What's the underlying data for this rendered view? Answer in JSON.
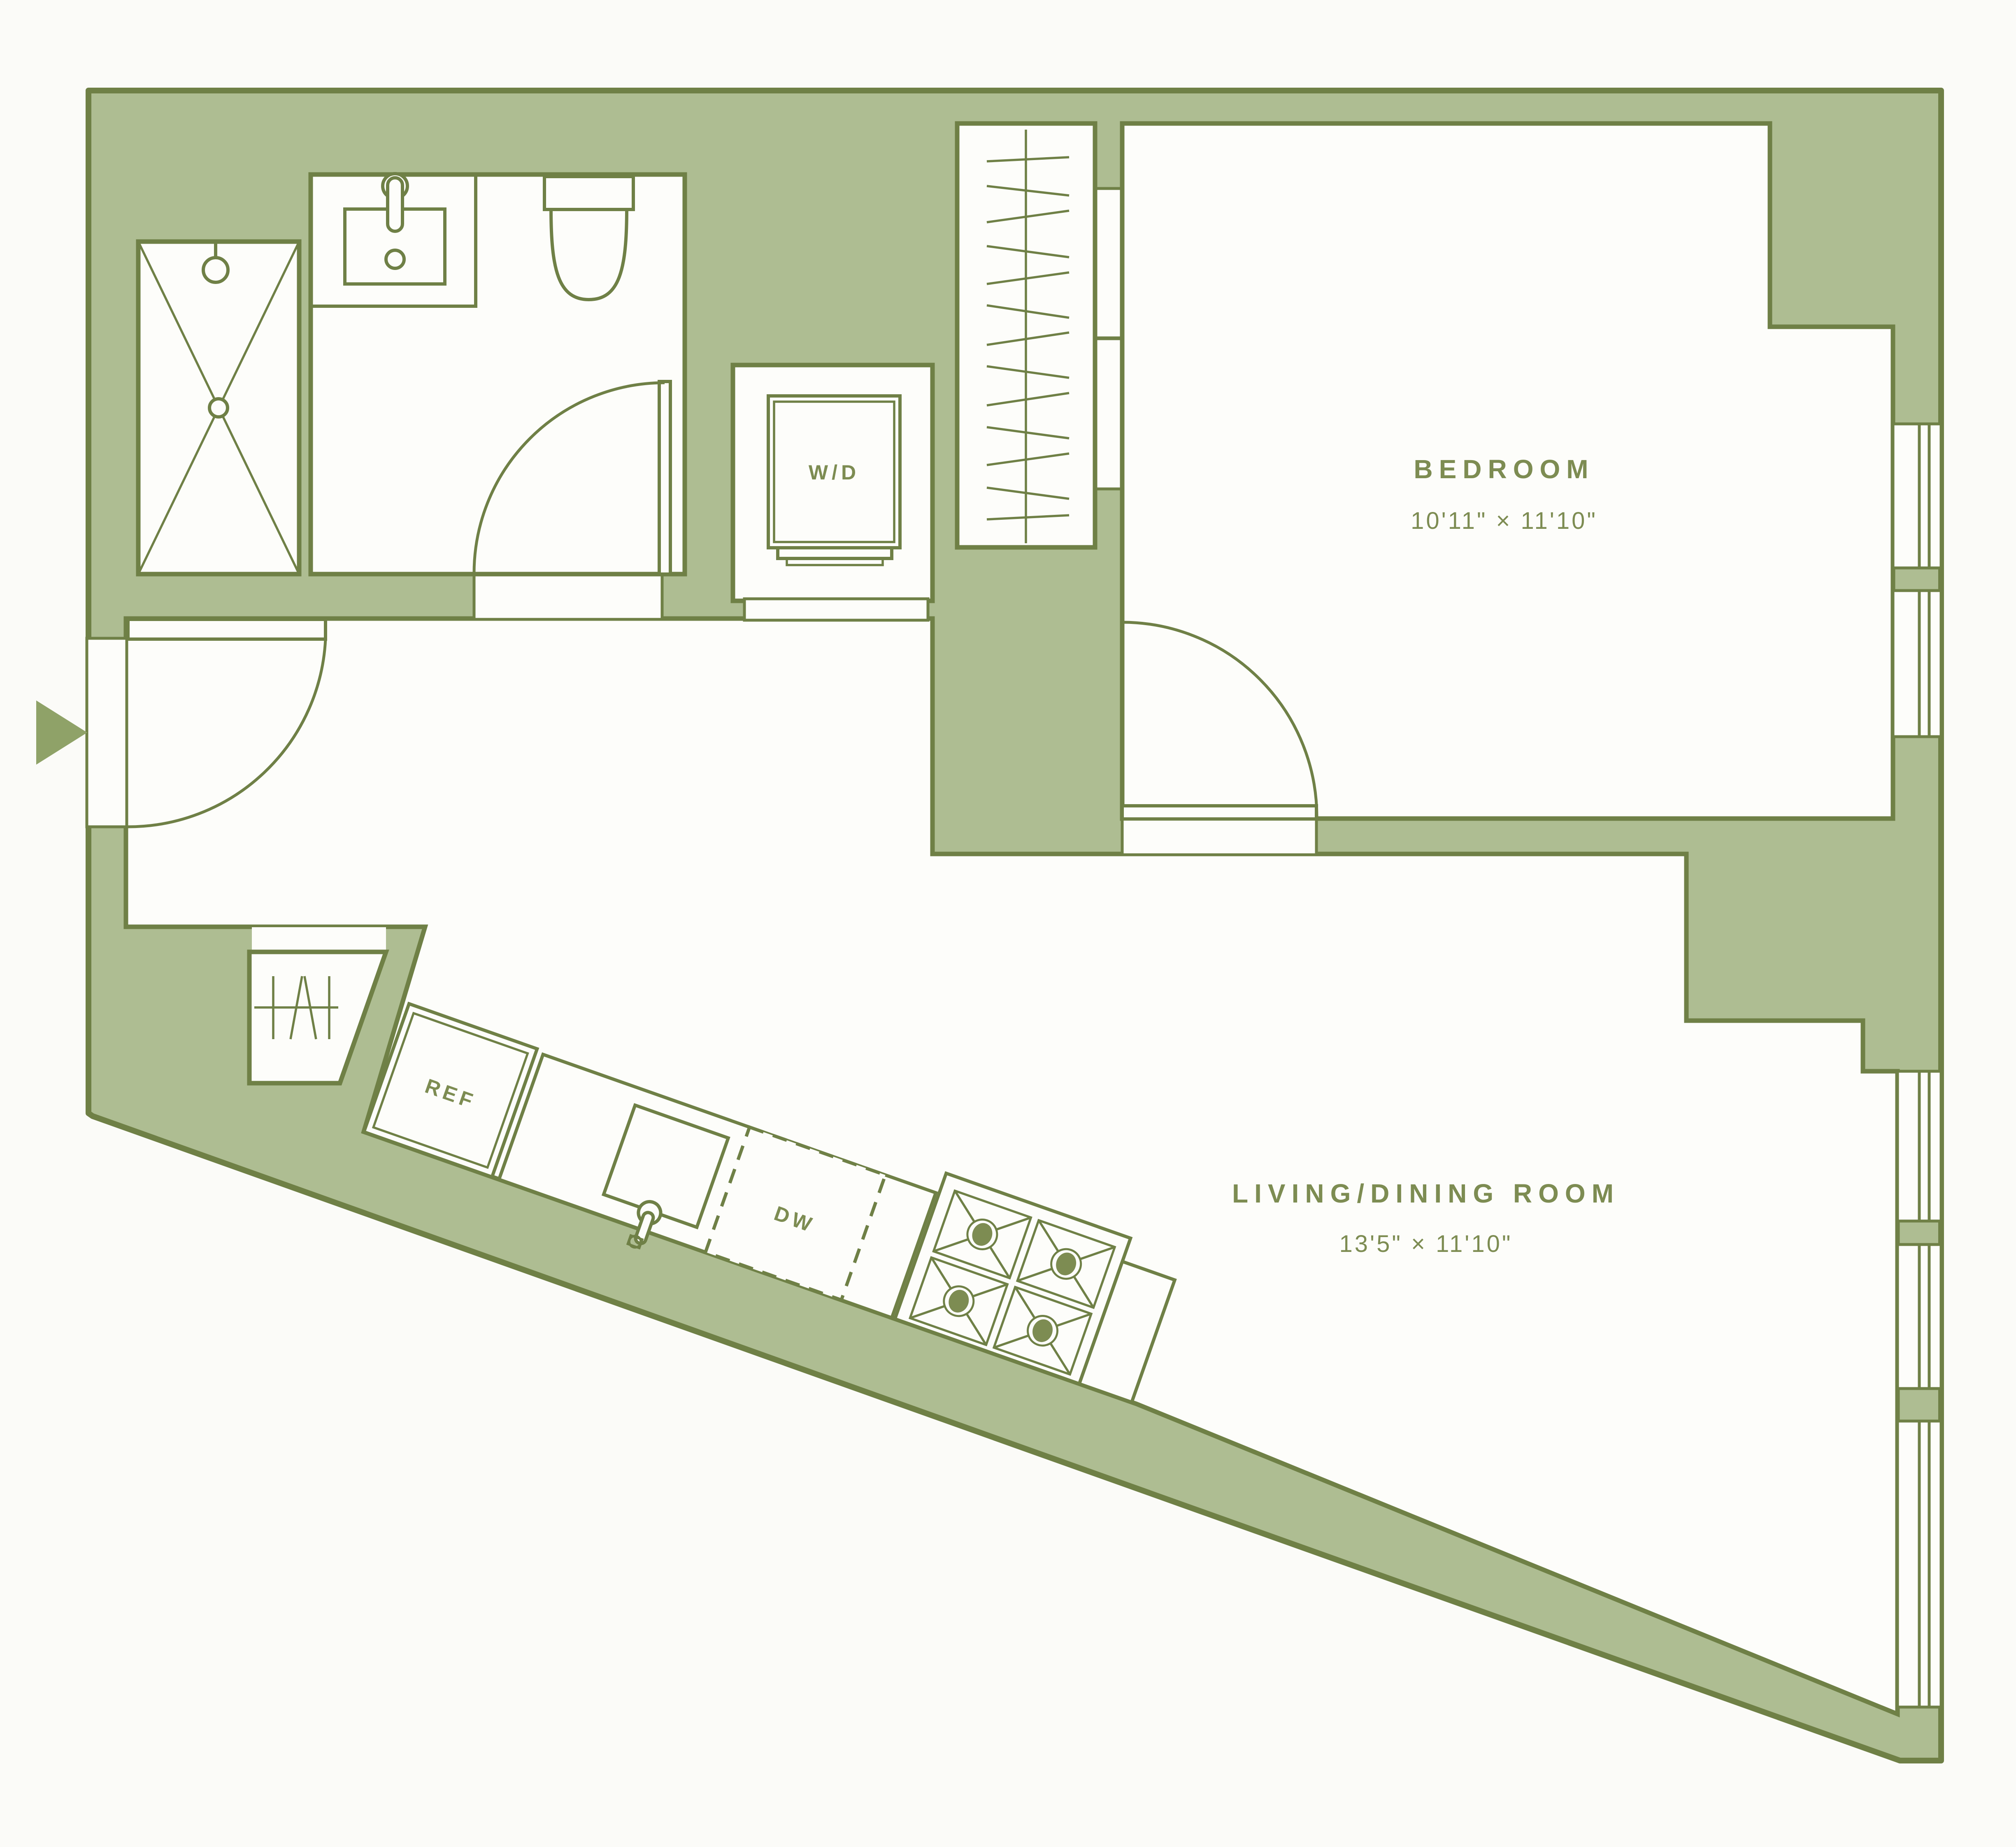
{
  "plan": {
    "type": "apartment-floor-plan",
    "rooms": {
      "bedroom": {
        "label": "BEDROOM",
        "dimensions": "10'11\" × 11'10\""
      },
      "living_dining": {
        "label": "LIVING/DINING ROOM",
        "dimensions": "13'5\" × 11'10\""
      }
    },
    "appliances": {
      "washer_dryer": "W/D",
      "refrigerator": "REF",
      "dishwasher": "DW"
    },
    "icons": {
      "entry_arrow": "solid triangle pointing right at entry",
      "shower": "rect with X and shower head",
      "sink": "vanity with basin and faucet",
      "toilet": "tank and bowl",
      "stove": "four burners",
      "closet_hangers": "rod with hanger ticks"
    },
    "colors": {
      "wall_fill": "#aebd92",
      "line": "#6f8046",
      "floor": "#fdfdfa",
      "background": "#fbfbf8",
      "label": "#7d8c52"
    }
  }
}
